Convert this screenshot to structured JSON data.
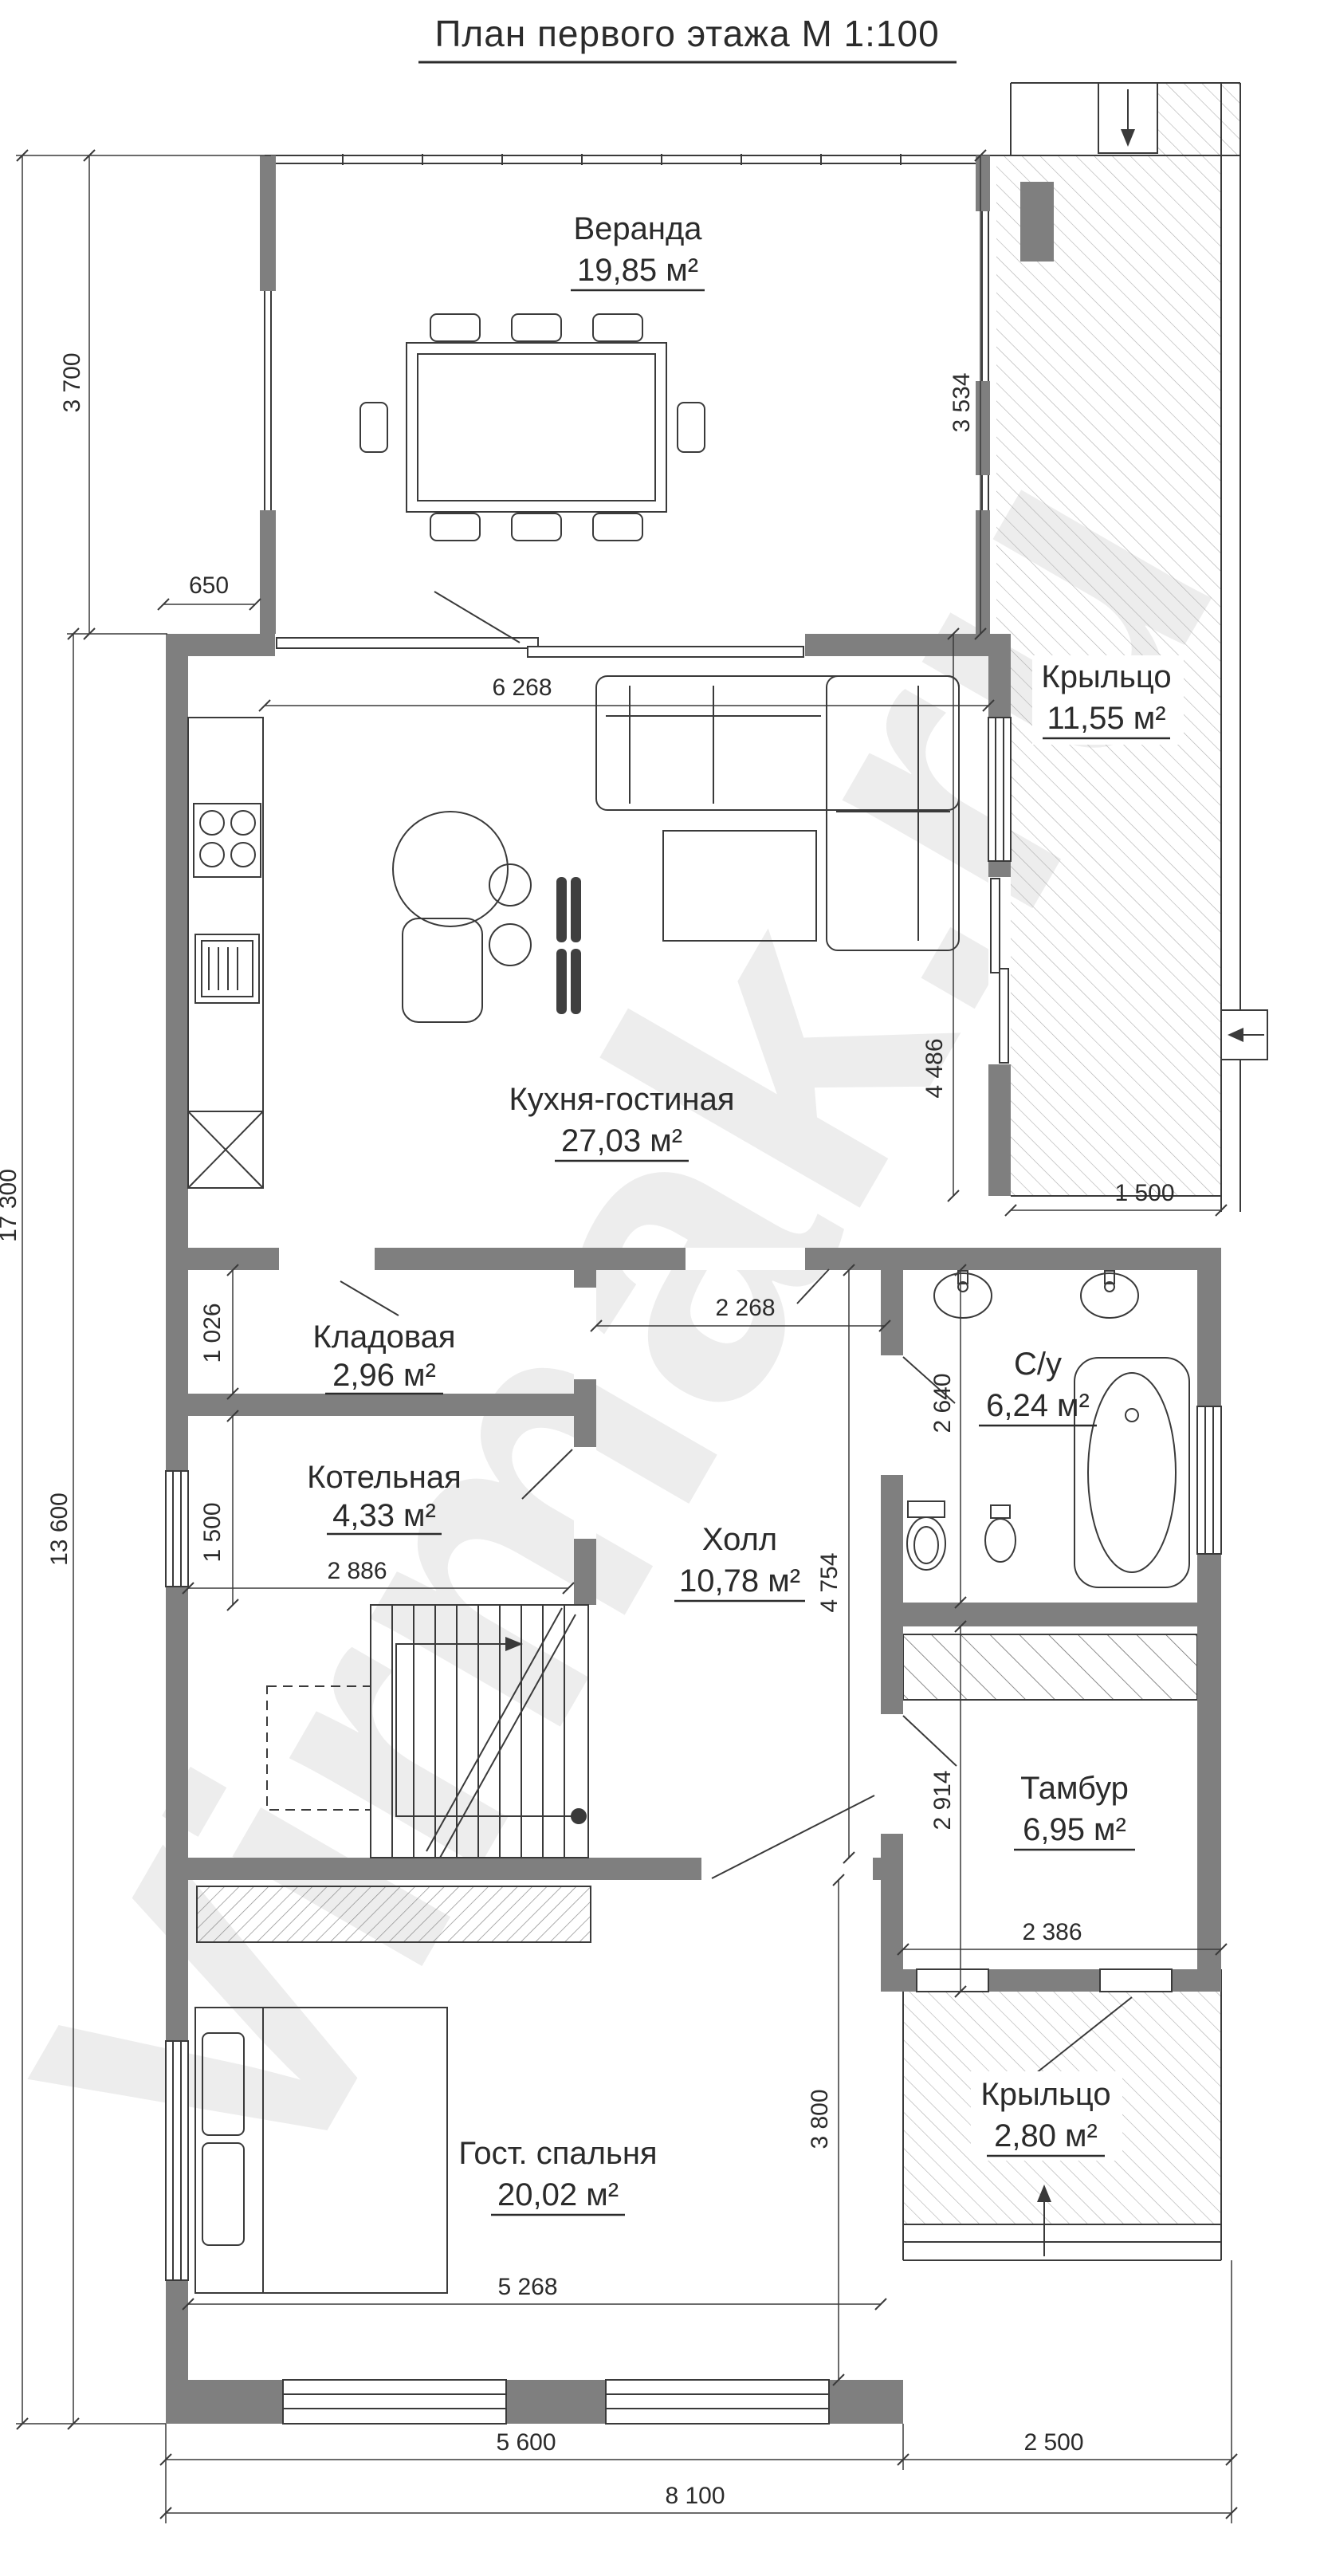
{
  "title": "План первого этажа М 1:100",
  "watermark": "Virmak.ru",
  "rooms": {
    "veranda": {
      "name": "Веранда",
      "area": "19,85 м²"
    },
    "porch_top": {
      "name": "Крыльцо",
      "area": "11,55 м²"
    },
    "kitchen_living": {
      "name": "Кухня-гостиная",
      "area": "27,03 м²"
    },
    "storage": {
      "name": "Кладовая",
      "area": "2,96 м²"
    },
    "boiler": {
      "name": "Котельная",
      "area": "4,33 м²"
    },
    "hall": {
      "name": "Холл",
      "area": "10,78 м²"
    },
    "bathroom": {
      "name": "С/у",
      "area": "6,24 м²"
    },
    "vestibule": {
      "name": "Тамбур",
      "area": "6,95 м²"
    },
    "porch_bottom": {
      "name": "Крыльцо",
      "area": "2,80 м²"
    },
    "bedroom": {
      "name": "Гост. спальня",
      "area": "20,02 м²"
    }
  },
  "dims": {
    "d3700": "3 700",
    "d17300": "17 300",
    "d13600": "13 600",
    "d650": "650",
    "d6268": "6 268",
    "d3534": "3 534",
    "d4486": "4 486",
    "d1500_right": "1 500",
    "d2268": "2 268",
    "d1026": "1 026",
    "d1500_left": "1 500",
    "d2886": "2 886",
    "d4754": "4 754",
    "d2640": "2 640",
    "d2914": "2 914",
    "d2386": "2 386",
    "d3800": "3 800",
    "d5268": "5 268",
    "d5600": "5 600",
    "d2500": "2 500",
    "d8100": "8 100"
  },
  "colors": {
    "wall": "#7f7f7f",
    "line": "#3a3a3a",
    "hatch": "#adadad",
    "watermark": "#ededed"
  }
}
